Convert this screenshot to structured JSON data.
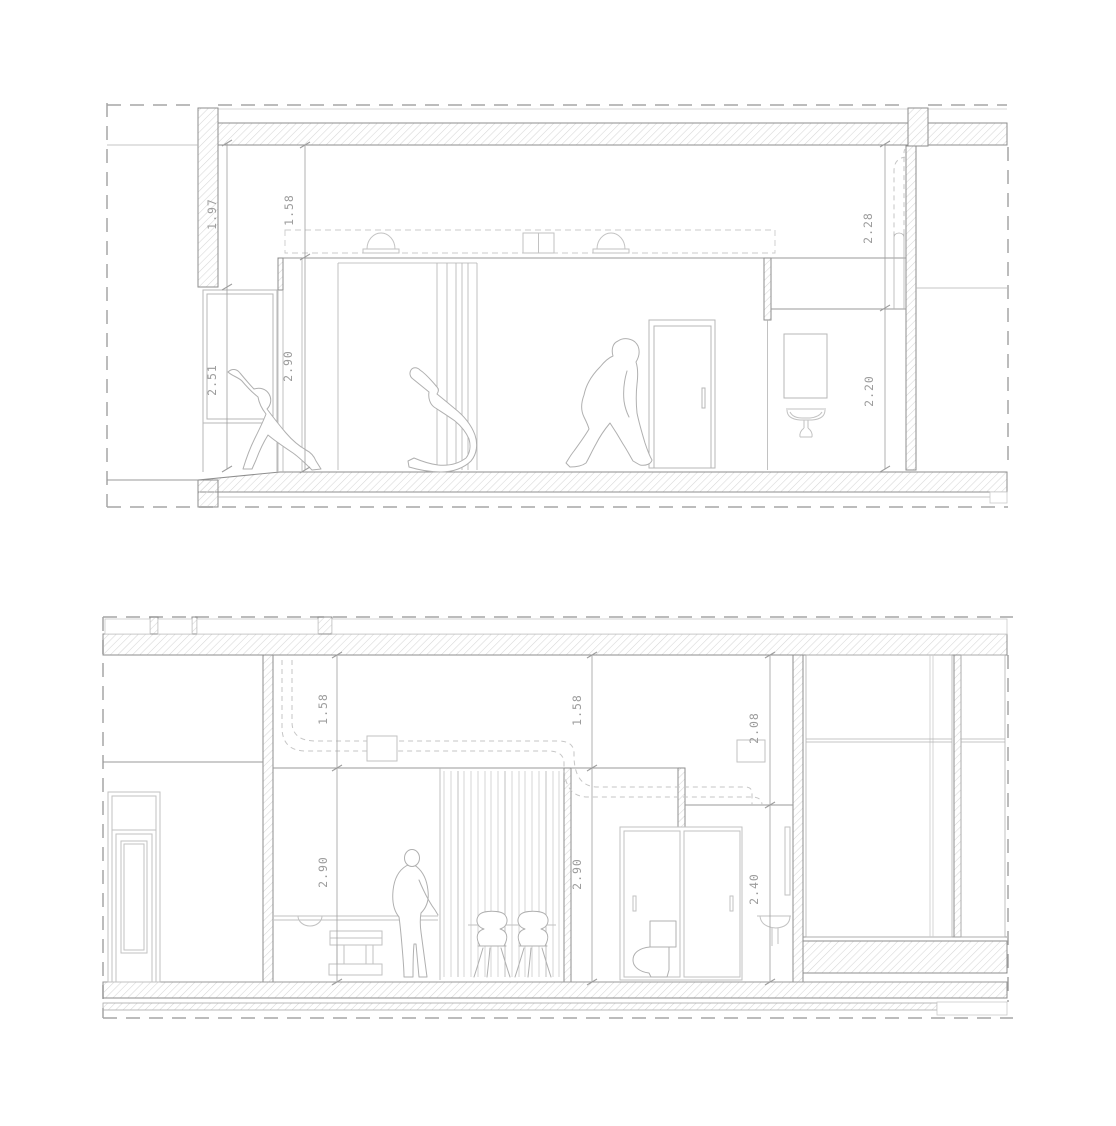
{
  "drawing": {
    "kind": "architectural cross sections",
    "colors": {
      "wall_outline": "#8e8e8e",
      "hatch_line": "#d6d6d6",
      "boundary_dash": "#a5a5a5",
      "annotation_text": "#9c9c9c",
      "furniture_line": "#c2c2c2",
      "figure_line": "#b0b0b0"
    }
  },
  "sections": {
    "upper": {
      "dims": {
        "lintel": "1.97",
        "soffit": "1.58",
        "duct_drop": "2.28",
        "window": "2.51",
        "room": "2.90",
        "bath": "2.20"
      }
    },
    "lower": {
      "dims": {
        "soffit_left": "1.58",
        "soffit_right": "1.58",
        "bath_drop": "2.08",
        "room_left": "2.90",
        "room_right": "2.90",
        "bath": "2.40"
      }
    }
  }
}
